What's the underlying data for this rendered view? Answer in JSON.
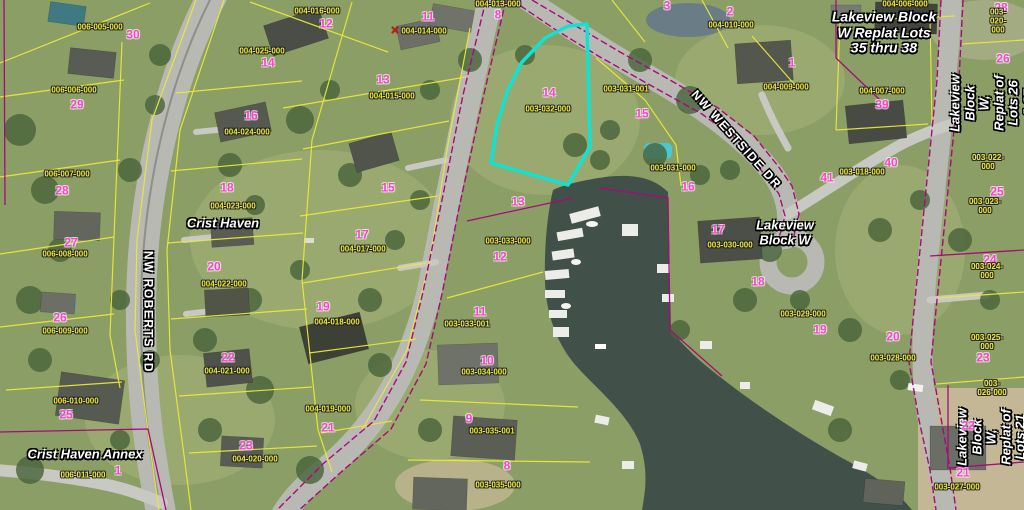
{
  "colors": {
    "highlight": "#0fe3d3",
    "parcel_line": "#e9e838",
    "boundary_line": "#a80a78",
    "lot_number": "#ff3fd0",
    "parcel_id": "#ece832",
    "water": "#42504a",
    "road": "#b9b9b3",
    "grass": "#8a9e66",
    "tree": "#47613a"
  },
  "map": {
    "selected_parcel": {
      "lot_number": "14",
      "parcel_id": "003-032-000"
    },
    "labels": [
      {
        "type": "street",
        "name": "street-label-nw-roberts-rd",
        "text": "NW ROBERTS RD",
        "x": 148,
        "y": 312,
        "rot": 90
      },
      {
        "type": "street",
        "name": "street-label-nw-westside-dr",
        "text": "NW WESTSIDE DR",
        "x": 736,
        "y": 140,
        "rot": 48
      },
      {
        "type": "block",
        "name": "block-label-crist-haven",
        "text": "Crist Haven",
        "x": 223,
        "y": 224
      },
      {
        "type": "block",
        "name": "block-label-crist-haven-annex",
        "text": "Crist Haven Annex",
        "x": 85,
        "y": 455
      },
      {
        "type": "block",
        "name": "block-label-lakeview-block-w",
        "text": "Lakeview\nBlock W",
        "x": 785,
        "y": 233
      },
      {
        "type": "block lg",
        "name": "block-label-lakeview-replat-35-38",
        "text": "Lakeview Block\nW Replat Lots\n35 thru 38",
        "x": 884,
        "y": 33
      },
      {
        "type": "block",
        "name": "block-label-lakeview-replat-26-27",
        "text": "Lakeview Block\nW, Replat of\nLots 26 & 27",
        "x": 992,
        "y": 103,
        "rot": -90
      },
      {
        "type": "block",
        "name": "block-label-lakeview-replat-21-22",
        "text": "Lakeview Block\nW, Replat of\nLots 21 and 22",
        "x": 999,
        "y": 437,
        "rot": -90
      },
      {
        "type": "marker",
        "name": "red-x-marker",
        "text": "✕",
        "x": 395,
        "y": 31
      },
      {
        "type": "lot",
        "text": "30",
        "x": 133,
        "y": 35
      },
      {
        "type": "lot",
        "text": "14",
        "x": 268,
        "y": 63
      },
      {
        "type": "lot",
        "text": "29",
        "x": 77,
        "y": 105
      },
      {
        "type": "lot",
        "text": "16",
        "x": 251,
        "y": 116
      },
      {
        "type": "lot",
        "text": "28",
        "x": 62,
        "y": 191
      },
      {
        "type": "lot",
        "text": "18",
        "x": 227,
        "y": 188
      },
      {
        "type": "lot",
        "text": "27",
        "x": 71,
        "y": 243
      },
      {
        "type": "lot",
        "text": "20",
        "x": 214,
        "y": 267
      },
      {
        "type": "lot",
        "text": "26",
        "x": 60,
        "y": 318
      },
      {
        "type": "lot",
        "text": "25",
        "x": 66,
        "y": 415
      },
      {
        "type": "lot",
        "text": "1",
        "x": 118,
        "y": 471
      },
      {
        "type": "lot",
        "text": "22",
        "x": 228,
        "y": 358
      },
      {
        "type": "lot",
        "text": "23",
        "x": 246,
        "y": 446
      },
      {
        "type": "lot",
        "text": "21",
        "x": 328,
        "y": 428
      },
      {
        "type": "lot",
        "text": "19",
        "x": 323,
        "y": 307
      },
      {
        "type": "lot",
        "text": "17",
        "x": 362,
        "y": 235
      },
      {
        "type": "lot",
        "text": "15",
        "x": 388,
        "y": 188
      },
      {
        "type": "lot",
        "text": "13",
        "x": 383,
        "y": 80
      },
      {
        "type": "lot",
        "text": "12",
        "x": 326,
        "y": 24
      },
      {
        "type": "lot",
        "text": "11",
        "x": 428,
        "y": 17
      },
      {
        "type": "lot",
        "text": "8",
        "x": 498,
        "y": 15
      },
      {
        "type": "lot",
        "text": "3",
        "x": 667,
        "y": 6
      },
      {
        "type": "lot",
        "text": "2",
        "x": 730,
        "y": 12
      },
      {
        "type": "lot",
        "text": "1",
        "x": 792,
        "y": 63
      },
      {
        "type": "lot",
        "text": "14",
        "x": 549,
        "y": 93
      },
      {
        "type": "lot",
        "text": "15",
        "x": 642,
        "y": 114
      },
      {
        "type": "lot",
        "text": "13",
        "x": 518,
        "y": 202
      },
      {
        "type": "lot",
        "text": "12",
        "x": 500,
        "y": 257
      },
      {
        "type": "lot",
        "text": "11",
        "x": 480,
        "y": 312
      },
      {
        "type": "lot",
        "text": "10",
        "x": 487,
        "y": 361
      },
      {
        "type": "lot",
        "text": "9",
        "x": 469,
        "y": 419
      },
      {
        "type": "lot",
        "text": "8",
        "x": 507,
        "y": 466
      },
      {
        "type": "lot",
        "text": "16",
        "x": 688,
        "y": 187
      },
      {
        "type": "lot",
        "text": "17",
        "x": 718,
        "y": 230
      },
      {
        "type": "lot",
        "text": "18",
        "x": 758,
        "y": 282
      },
      {
        "type": "lot",
        "text": "19",
        "x": 820,
        "y": 330
      },
      {
        "type": "lot",
        "text": "20",
        "x": 893,
        "y": 337
      },
      {
        "type": "lot",
        "text": "41",
        "x": 827,
        "y": 178
      },
      {
        "type": "lot",
        "text": "40",
        "x": 891,
        "y": 163
      },
      {
        "type": "lot",
        "text": "39",
        "x": 882,
        "y": 105
      },
      {
        "type": "lot",
        "text": "28",
        "x": 1001,
        "y": 8
      },
      {
        "type": "lot",
        "text": "26",
        "x": 1003,
        "y": 59
      },
      {
        "type": "lot",
        "text": "25",
        "x": 997,
        "y": 192
      },
      {
        "type": "lot",
        "text": "24",
        "x": 990,
        "y": 260
      },
      {
        "type": "lot",
        "text": "23",
        "x": 983,
        "y": 358
      },
      {
        "type": "lot",
        "text": "22",
        "x": 968,
        "y": 426
      },
      {
        "type": "lot",
        "text": "21",
        "x": 963,
        "y": 473
      },
      {
        "type": "pid",
        "text": "006-005-000",
        "x": 100,
        "y": 28
      },
      {
        "type": "pid",
        "text": "004-025-000",
        "x": 262,
        "y": 52
      },
      {
        "type": "pid",
        "text": "006-006-000",
        "x": 74,
        "y": 91
      },
      {
        "type": "pid",
        "text": "004-024-000",
        "x": 247,
        "y": 133
      },
      {
        "type": "pid",
        "text": "006-007-000",
        "x": 67,
        "y": 175
      },
      {
        "type": "pid",
        "text": "004-023-000",
        "x": 233,
        "y": 207
      },
      {
        "type": "pid",
        "text": "006-008-000",
        "x": 65,
        "y": 255
      },
      {
        "type": "pid",
        "text": "004-022-000",
        "x": 224,
        "y": 285
      },
      {
        "type": "pid",
        "text": "006-009-000",
        "x": 65,
        "y": 332
      },
      {
        "type": "pid",
        "text": "006-010-000",
        "x": 76,
        "y": 402
      },
      {
        "type": "pid",
        "text": "006-011-000",
        "x": 83,
        "y": 476
      },
      {
        "type": "pid",
        "text": "004-021-000",
        "x": 227,
        "y": 372
      },
      {
        "type": "pid",
        "text": "004-020-000",
        "x": 255,
        "y": 460
      },
      {
        "type": "pid",
        "text": "004-019-000",
        "x": 328,
        "y": 410
      },
      {
        "type": "pid",
        "text": "004-018-000",
        "x": 337,
        "y": 323
      },
      {
        "type": "pid",
        "text": "004-017-000",
        "x": 363,
        "y": 250
      },
      {
        "type": "pid",
        "text": "004-016-000",
        "x": 317,
        "y": 12
      },
      {
        "type": "pid",
        "text": "004-015-000",
        "x": 392,
        "y": 97
      },
      {
        "type": "pid",
        "text": "004-014-000",
        "x": 424,
        "y": 32
      },
      {
        "type": "pid",
        "text": "004-013-000",
        "x": 498,
        "y": 5
      },
      {
        "type": "pid",
        "text": "004-010-000",
        "x": 731,
        "y": 26
      },
      {
        "type": "pid",
        "text": "004-009-000",
        "x": 786,
        "y": 88
      },
      {
        "type": "pid",
        "text": "004-006-000",
        "x": 905,
        "y": 5
      },
      {
        "type": "pid",
        "text": "004-007-000",
        "x": 882,
        "y": 92
      },
      {
        "type": "pid",
        "text": "003-020-000",
        "x": 998,
        "y": 22
      },
      {
        "type": "pid",
        "text": "003-022-000",
        "x": 988,
        "y": 163
      },
      {
        "type": "pid",
        "text": "003-023-000",
        "x": 985,
        "y": 207
      },
      {
        "type": "pid",
        "text": "003-024-000",
        "x": 987,
        "y": 272
      },
      {
        "type": "pid",
        "text": "003-025-000",
        "x": 987,
        "y": 343
      },
      {
        "type": "pid",
        "text": "003-026-000",
        "x": 992,
        "y": 389
      },
      {
        "type": "pid",
        "text": "003-027-000",
        "x": 957,
        "y": 488
      },
      {
        "type": "pid",
        "text": "003-028-000",
        "x": 893,
        "y": 359
      },
      {
        "type": "pid",
        "text": "003-029-000",
        "x": 803,
        "y": 315
      },
      {
        "type": "pid",
        "text": "003-030-000",
        "x": 730,
        "y": 246
      },
      {
        "type": "pid",
        "text": "003-031-000",
        "x": 673,
        "y": 169
      },
      {
        "type": "pid",
        "text": "003-031-001",
        "x": 626,
        "y": 90
      },
      {
        "type": "pid",
        "text": "003-032-000",
        "x": 548,
        "y": 110
      },
      {
        "type": "pid",
        "text": "003-033-000",
        "x": 508,
        "y": 242
      },
      {
        "type": "pid",
        "text": "003-033-001",
        "x": 467,
        "y": 325
      },
      {
        "type": "pid",
        "text": "003-034-000",
        "x": 484,
        "y": 373
      },
      {
        "type": "pid",
        "text": "003-035-001",
        "x": 492,
        "y": 432
      },
      {
        "type": "pid",
        "text": "003-035-000",
        "x": 498,
        "y": 486
      },
      {
        "type": "pid",
        "text": "003-018-000",
        "x": 862,
        "y": 173
      }
    ]
  }
}
